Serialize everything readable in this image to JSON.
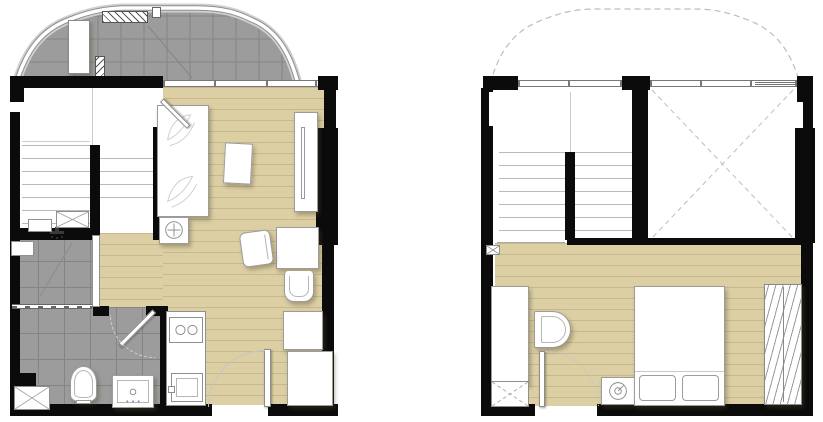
{
  "page": {
    "title": "Duplex apartment floor plan — lower and upper level",
    "type": "architectural-floor-plan",
    "visible_text": []
  },
  "colors": {
    "wall": "#0b0b0b",
    "wood": "#dccfa4",
    "wood_line": "#c7b88d",
    "tile": "#9c9c9c",
    "tile_line": "#848484",
    "fixture_border": "#9c9c9c",
    "stair_line": "#b9b9b9",
    "thin_line": "#cccccc",
    "dash_line": "#bdbdbd",
    "balcony_rail": "#8e8e8e"
  },
  "legend": {
    "balcony": "Balcony with tiled floor and curved railing",
    "ac_unit": "Air-conditioning condenser unit",
    "louver": "Hatched condenser louver",
    "bed_lower": "Single bed with leaf-pattern cover",
    "coffee_table": "Coffee table",
    "tv_console": "TV console",
    "dining_table": "Dining table with two chairs",
    "kitchen_counter": "Kitchen counter with two-burner stove and sink",
    "bathroom": "Bathroom with shower, toilet and vanity",
    "toilet": "Toilet",
    "vanity": "Vanity sink",
    "stairs": "Staircase between duplex levels",
    "void": "Void open to below",
    "bedroom_bed": "Double bed with two pillows",
    "wardrobe": "Wardrobe with clothes hangers",
    "washer": "Washing machine",
    "desk": "Desk with chair",
    "shaft": "Service shaft",
    "dashed_outline": "Balcony roof outline (dashed, below)"
  },
  "units": [
    {
      "name": "lower-floor-unit",
      "rooms": [
        "balcony",
        "staircase",
        "sleeping-area",
        "living-dining",
        "kitchen",
        "shower-room",
        "bathroom",
        "entrance"
      ],
      "fixtures": [
        "air-conditioning-unit",
        "condenser-louver",
        "vent-grille",
        "bed",
        "bedside-stool",
        "coffee-table",
        "tv-console",
        "dining-table",
        "dining-chair-left",
        "dining-chair-front",
        "cabinet",
        "tall-cabinet",
        "kitchen-counter",
        "two-burner-stove",
        "kitchen-sink",
        "entrance-door",
        "bathroom-door",
        "shower-partition",
        "shower-head",
        "toilet",
        "vanity-sink",
        "duct-box",
        "service-shaft"
      ]
    },
    {
      "name": "upper-floor-unit",
      "rooms": [
        "staircase",
        "void-open-to-below",
        "bedroom"
      ],
      "fixtures": [
        "desk",
        "desk-chair",
        "bedroom-door",
        "washing-machine",
        "double-bed",
        "pillow-left",
        "pillow-right",
        "wardrobe-with-hangers",
        "service-shaft",
        "drain-marker"
      ]
    }
  ]
}
